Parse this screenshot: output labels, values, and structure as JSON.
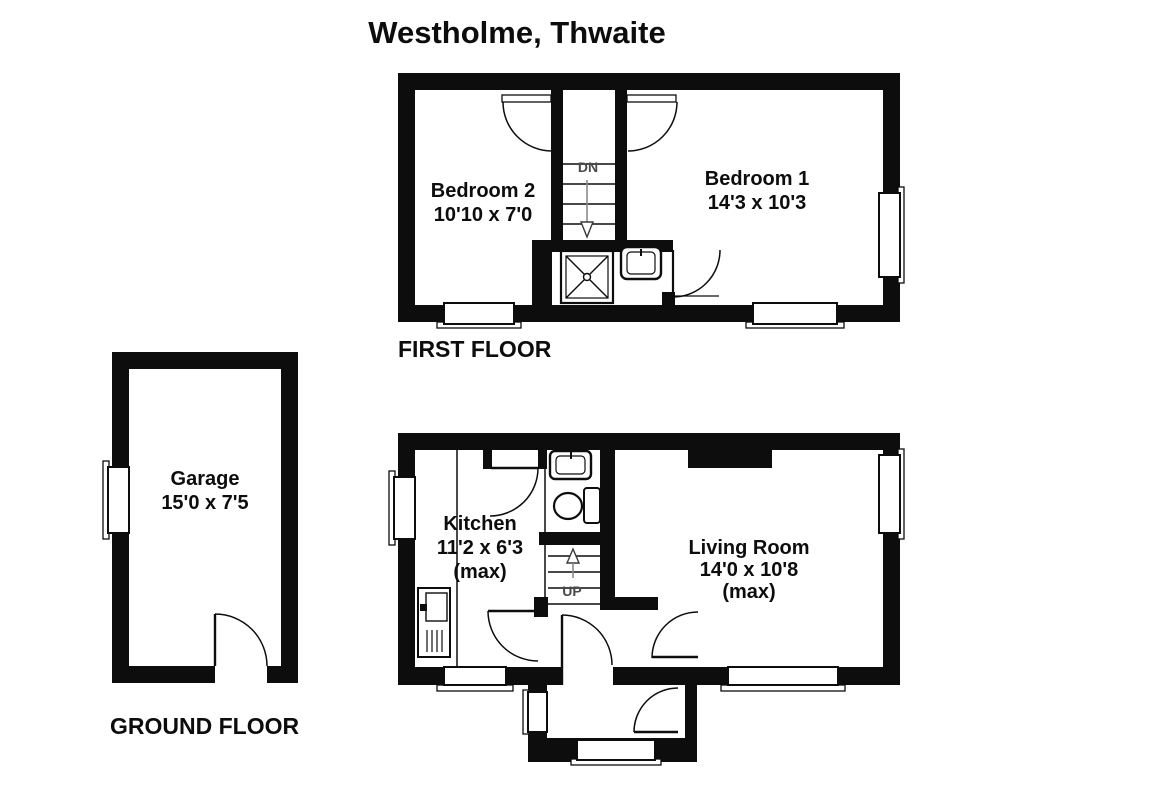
{
  "title": "Westholme, Thwaite",
  "first_floor": {
    "label": "FIRST FLOOR",
    "bedroom1": {
      "name": "Bedroom 1",
      "dims": "14'3 x 10'3"
    },
    "bedroom2": {
      "name": "Bedroom 2",
      "dims": "10'10 x 7'0"
    },
    "stairs_label": "DN"
  },
  "ground_floor": {
    "label": "GROUND FLOOR",
    "kitchen": {
      "name": "Kitchen",
      "dims": "11'2 x 6'3",
      "qualifier": "(max)"
    },
    "living_room": {
      "name": "Living Room",
      "dims": "14'0 x 10'8",
      "qualifier": "(max)"
    },
    "stairs_label": "UP"
  },
  "garage": {
    "name": "Garage",
    "dims": "15'0 x 7'5"
  },
  "colors": {
    "wall": "#0d0d0d",
    "background": "#ffffff"
  }
}
